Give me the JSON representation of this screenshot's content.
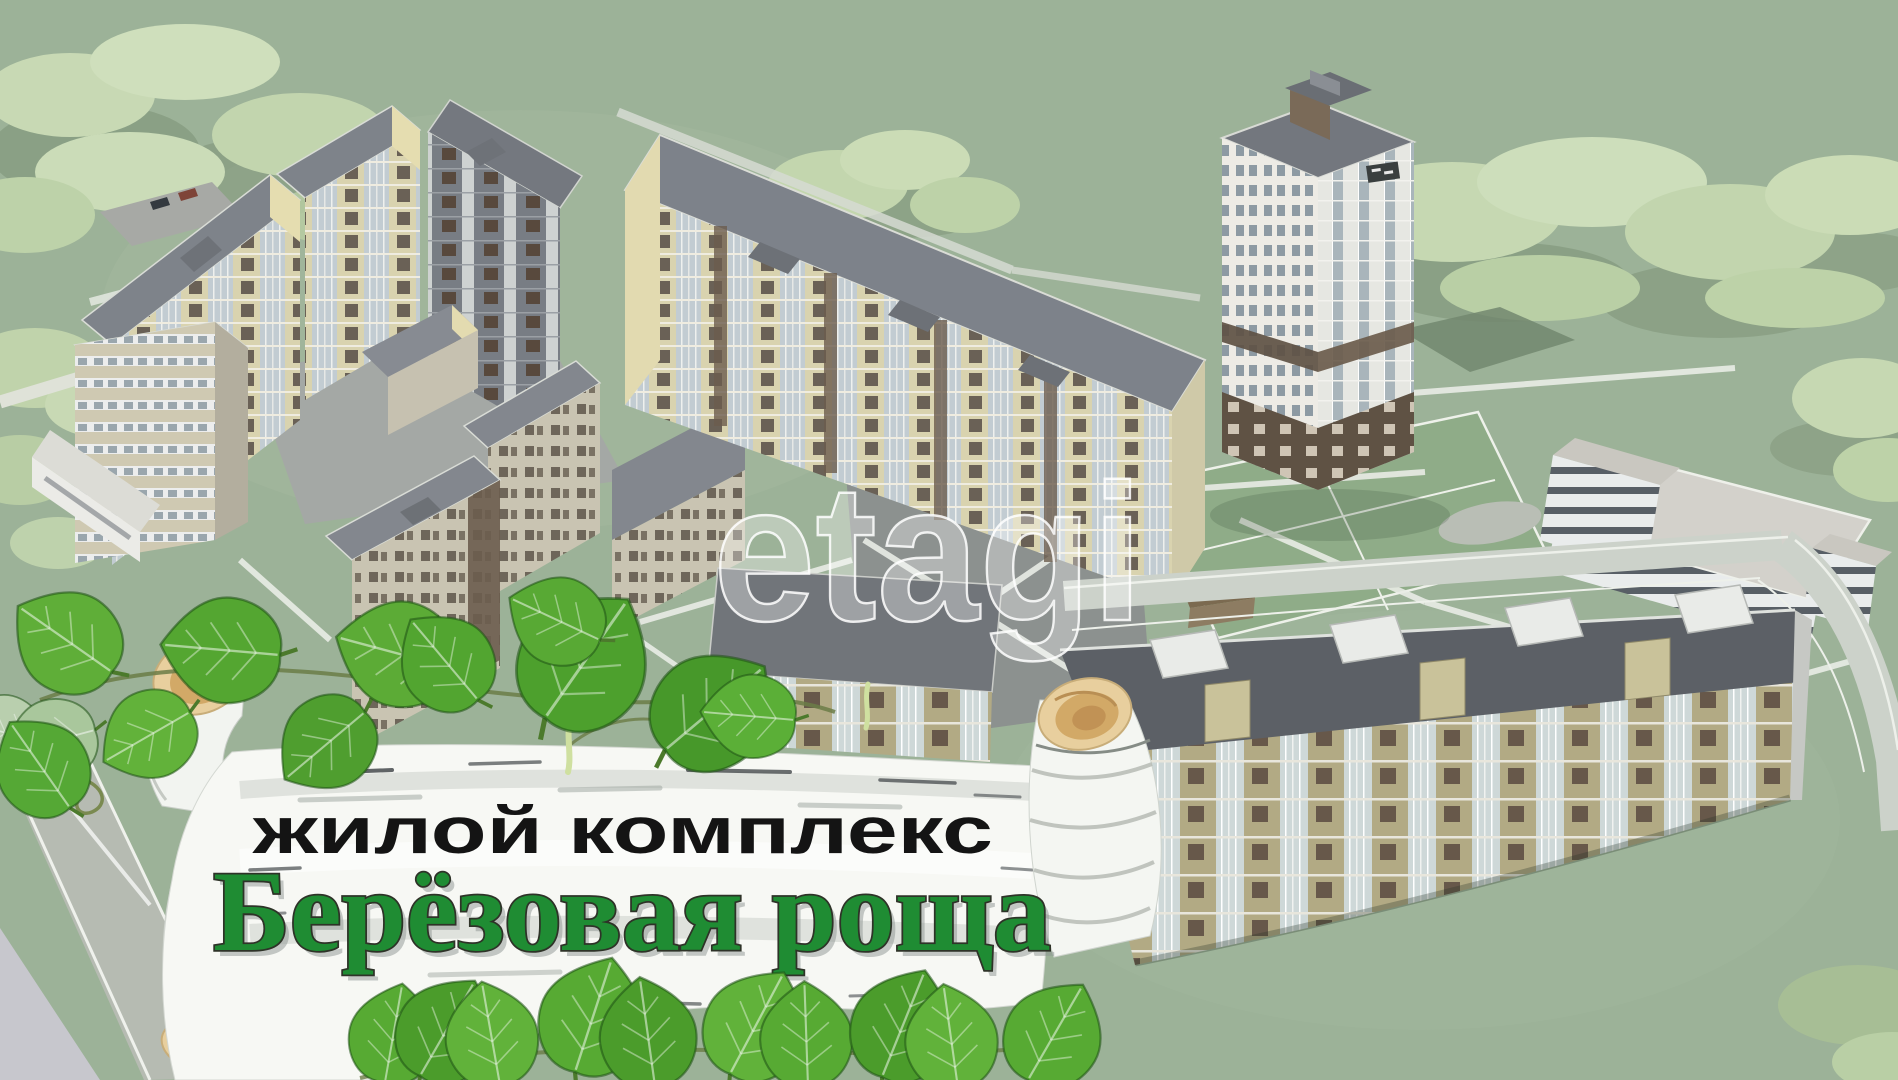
{
  "banner": {
    "subtitle": "жилой комплекс",
    "title": "Берёзовая роща",
    "subtitle_color": "#141414",
    "title_color": "#1f8c33",
    "title_outline": "#2e3328"
  },
  "watermark": {
    "text": "etagi",
    "color": "#ffffff"
  },
  "palette": {
    "ground": "#9cb298",
    "tree_light": "#c6d8b2",
    "tree_shadow": "#7f9478",
    "road": "#c3c8c0",
    "path_white": "#e9ece6",
    "bark_white": "#f7f8f4",
    "bark_roll_tan": "#e8cf9e",
    "leaf_green": "#57aa33",
    "facade_cream": "#d9d3af",
    "facade_olive": "#b2aa84",
    "facade_brown": "#6b5d4d",
    "roof_grey": "#7d828a",
    "roof_dark": "#5c6066"
  }
}
